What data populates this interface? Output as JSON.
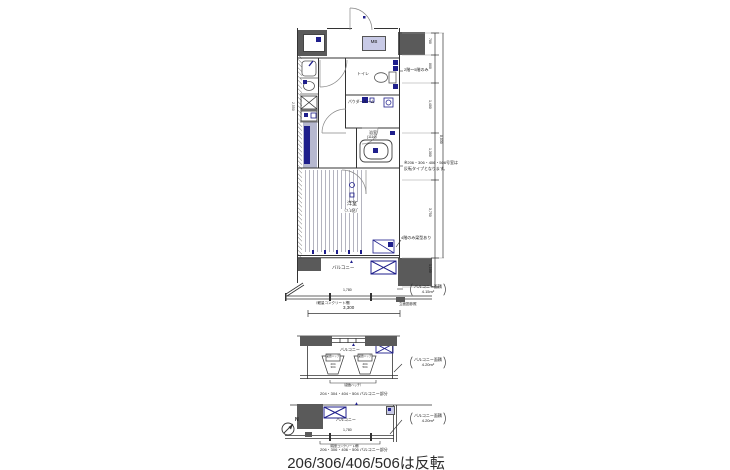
{
  "labels": {
    "mb": "MB",
    "toilet": "トイレ",
    "powder": "パウダールーム",
    "bath": "浴室",
    "bath_dim": "(1116)",
    "room": "洋室",
    "room_size": "（7.1帖）",
    "balcony": "バルコニー",
    "floors_only": "2階〜5階のみ",
    "mirror_line1": "※206・306・406・506号室は",
    "mirror_line2": "反転タイプとなります。",
    "beam": "4階のみ梁型あり",
    "fence": "（軽量コンクリート柵）",
    "elev_ref": "立面図参照"
  },
  "dims": {
    "width": "3,300",
    "rail": "1,780",
    "left": "2,550",
    "total": "8,030",
    "segments": [
      "780",
      "800",
      "1,400",
      "1,300",
      "3,750",
      "1,100"
    ]
  },
  "area": {
    "main_label": "バルコニー面積",
    "main_value": "4.15m²"
  },
  "mid": {
    "balcony": "バルコニー",
    "hatch": "避難ハッチ",
    "left_units": "204\n304",
    "right_units": "404\n504",
    "bracket": "（避難ハッチ）",
    "caption": "204・304・404・504 バルコニー部分",
    "area_label": "バルコニー面積",
    "area_value": "4.20m²"
  },
  "bottom": {
    "balcony": "バルコニー",
    "caption": "206・306・406・506 バルコニー部分",
    "fence": "（軽量コンクリート柵）",
    "north": "N",
    "area_label": "バルコニー面積",
    "area_value": "4.20m²",
    "rail_dim": "1,780"
  },
  "footer": {
    "title": "206/306/406/506は反転"
  }
}
